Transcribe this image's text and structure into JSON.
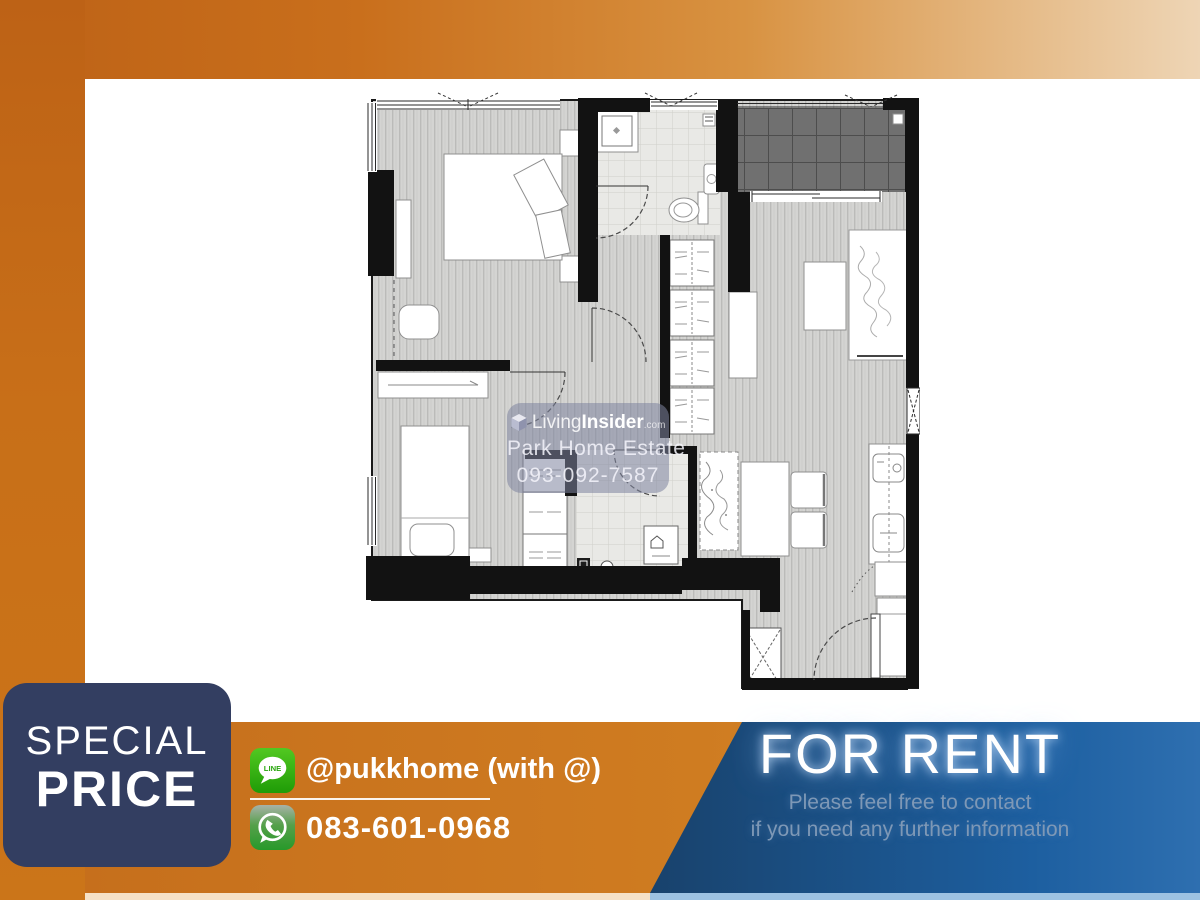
{
  "badge": {
    "line1": "SPECIAL",
    "line2": "PRICE"
  },
  "contact": {
    "line_label": "@pukkhome (with @)",
    "line_icon_text": "LINE",
    "whatsapp_label": "083-601-0968"
  },
  "promo": {
    "title": "FOR RENT",
    "subtitle1": "Please feel free to contact",
    "subtitle2": "if you need any further information"
  },
  "watermark": {
    "brand_prefix": "Living",
    "brand_suffix": "Insider",
    "brand_tld": ".com",
    "agency": "Park Home Estate",
    "phone": "093-092-7587"
  },
  "colors": {
    "orange_dark": "#bd6216",
    "orange_mid": "#cd7a1f",
    "beige_light": "#eed5b5",
    "navy_badge": "#333e61",
    "blue_dark": "#152839",
    "blue_mid": "#1d5fa0",
    "subtitle_text": "#7e98b6",
    "line_green": "#45c319",
    "whatsapp_green": "#2f9e2f"
  }
}
